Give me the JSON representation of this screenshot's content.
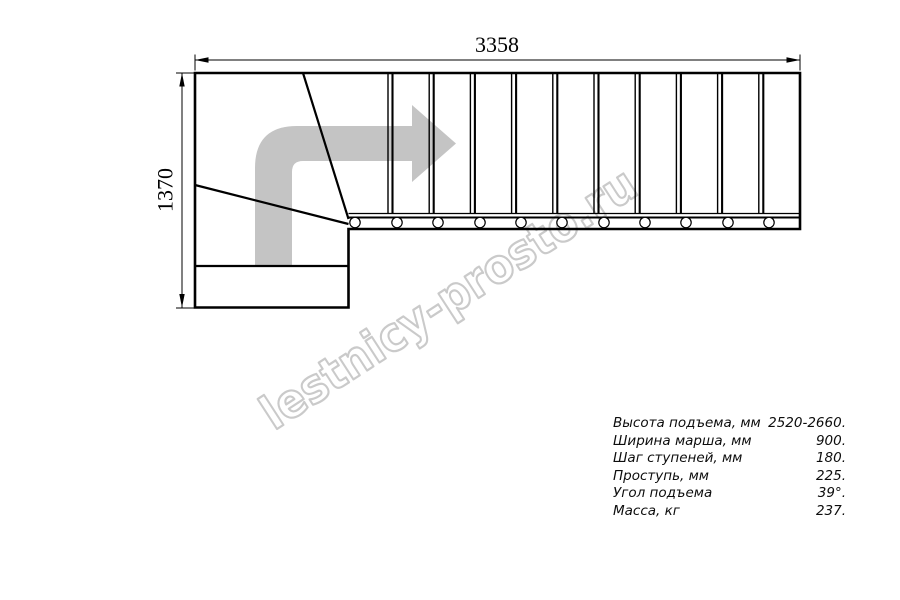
{
  "diagram": {
    "top_dimension_label": "3358",
    "left_dimension_label": "1370",
    "watermark_text": "lestnicy-prosto.ru"
  },
  "specs": {
    "rows": [
      {
        "label": "Высота подъема, мм",
        "value": "2520-2660."
      },
      {
        "label": "Ширина марша, мм",
        "value": "900."
      },
      {
        "label": "Шаг ступеней, мм",
        "value": "180."
      },
      {
        "label": "Проступь, мм",
        "value": "225."
      },
      {
        "label": "Угол подъема",
        "value": "39°."
      },
      {
        "label": "Масса, кг",
        "value": "237."
      }
    ]
  },
  "colors": {
    "line": "#000000",
    "arrow": "#c4c4c4",
    "watermark": "#cacaca"
  }
}
